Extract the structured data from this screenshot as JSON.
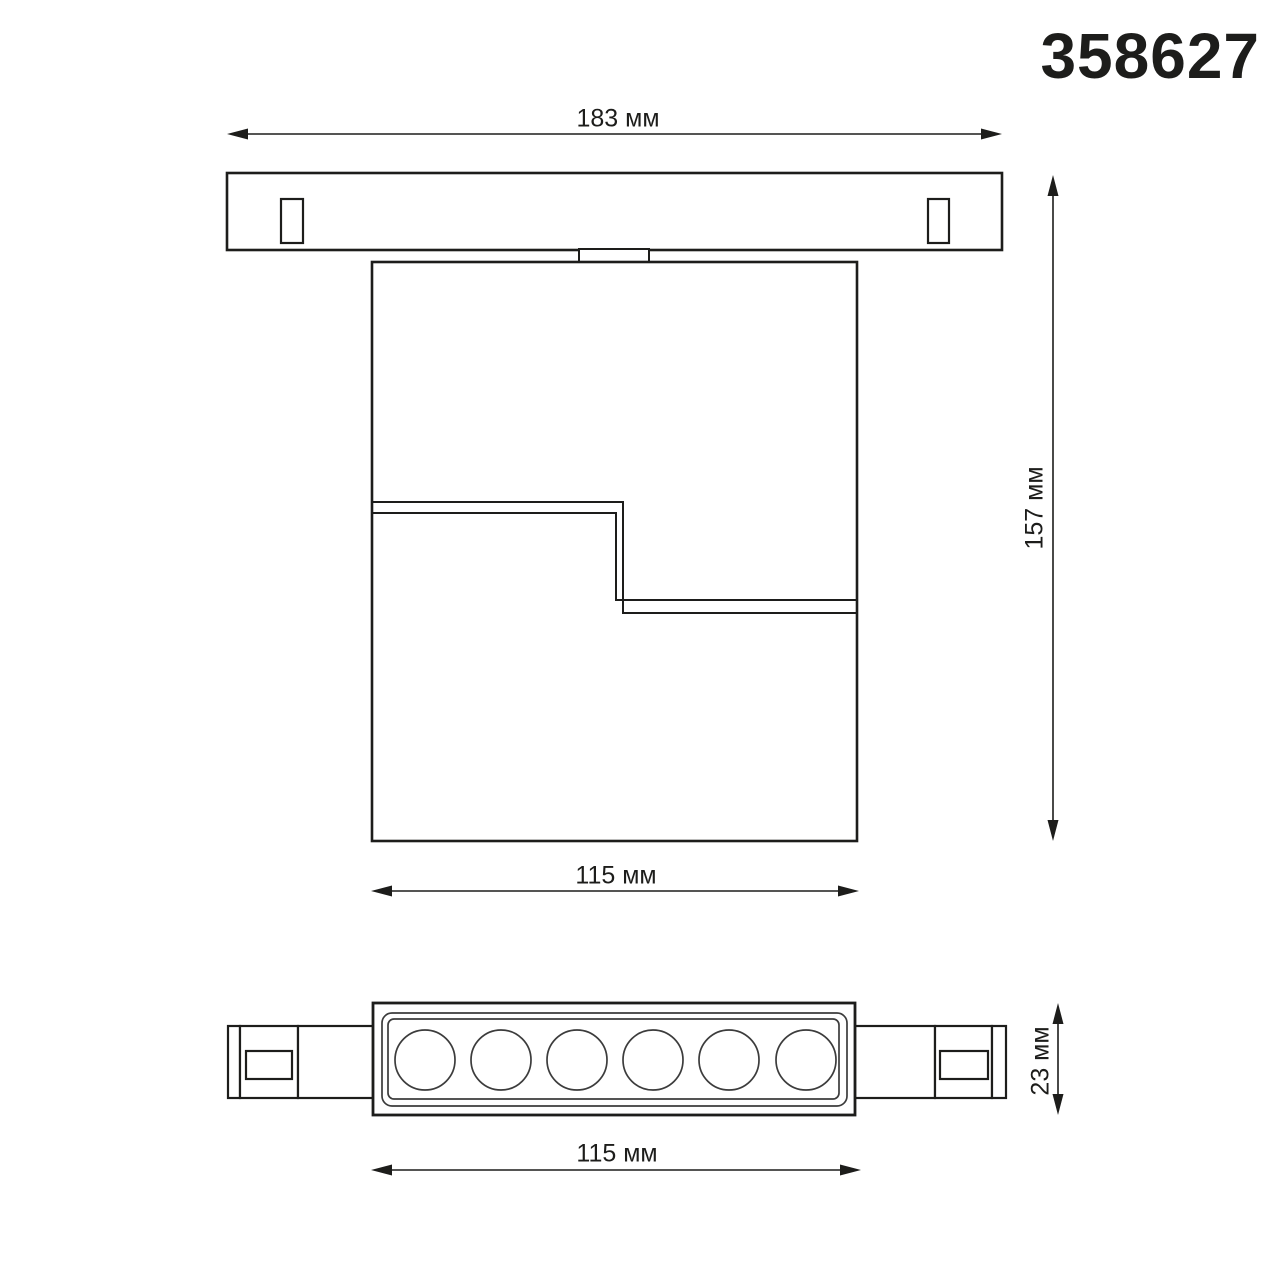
{
  "product": {
    "code": "358627"
  },
  "colors": {
    "background": "#ffffff",
    "line": "#1d1d1b",
    "thin_line": "#3c3c3c"
  },
  "views": {
    "front": {
      "dimensions": {
        "track_width": "183 мм",
        "overall_height": "157 мм",
        "body_width": "115 мм"
      }
    },
    "bottom": {
      "dimensions": {
        "body_width": "115 мм",
        "body_depth": "23 мм"
      }
    }
  },
  "icons": {
    "dimension_arrow": "solid triangle arrowhead"
  }
}
